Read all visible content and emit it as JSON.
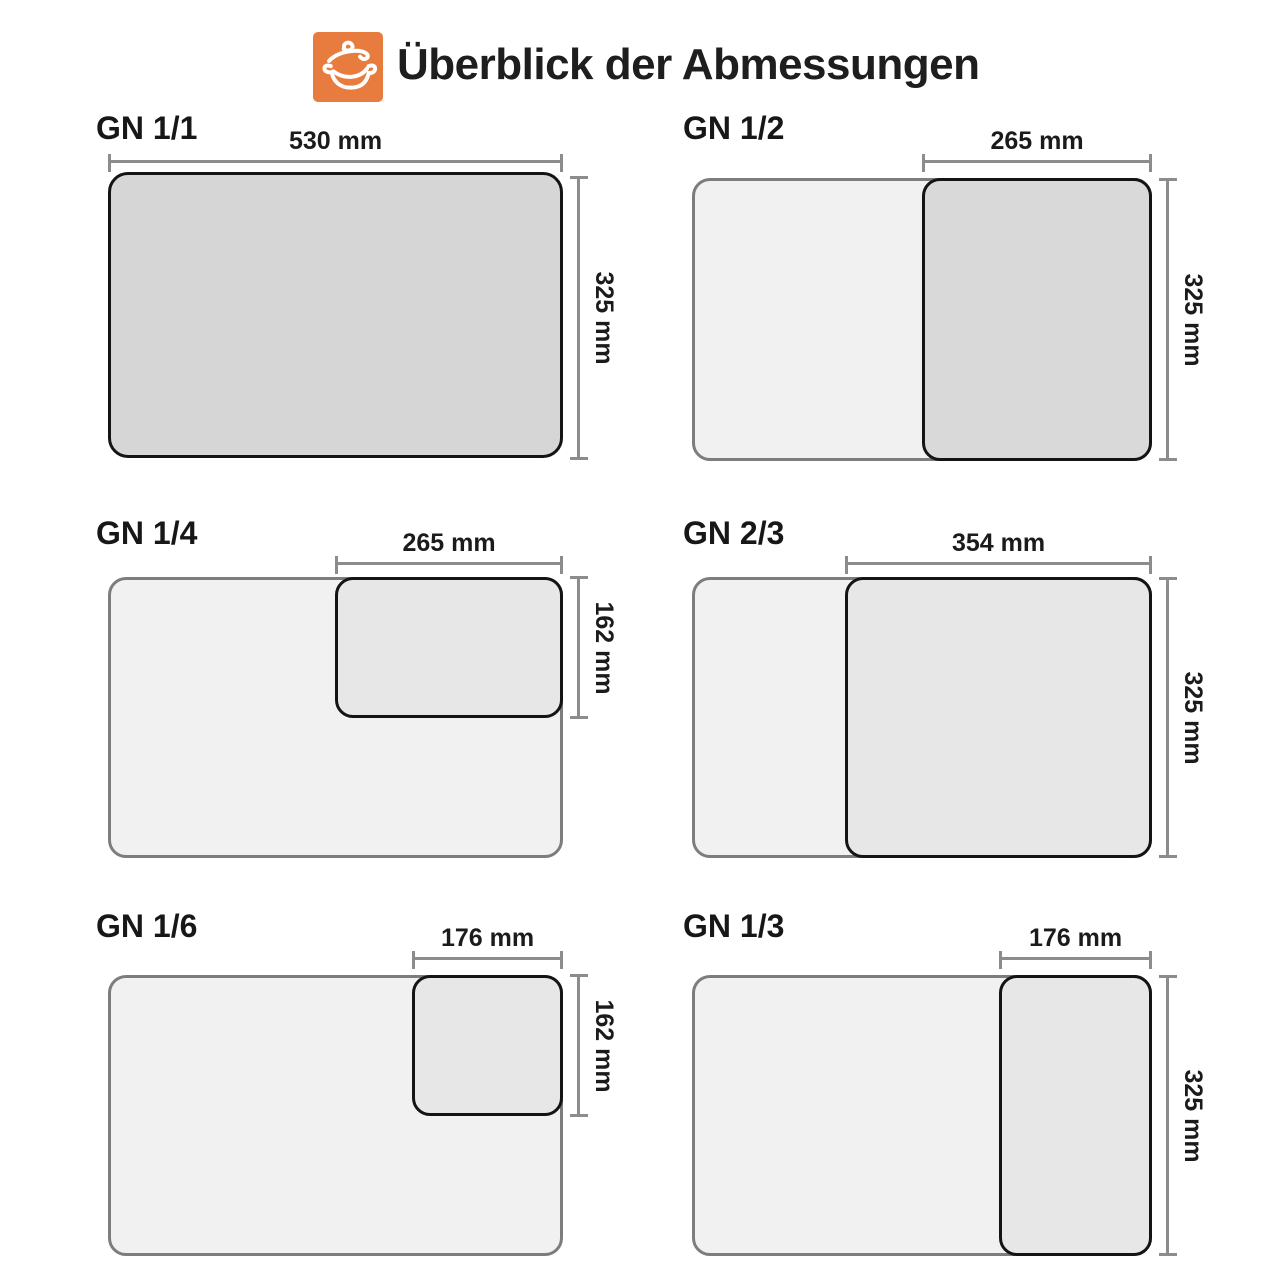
{
  "header": {
    "title": "Überblick der Abmessungen",
    "logo_icon": "pot-icon",
    "logo_color": "#e87c3e"
  },
  "colors": {
    "accent_orange": "#e87c3e",
    "full_pan_fill": "#d6d6d6",
    "half_pan_fill": "#d9d9d9",
    "small_pan_fill": "#e7e7e7",
    "base_pan_fill": "#f1f1f1",
    "base_pan_outline": "#7d7d7d",
    "highlight_outline": "#141414",
    "dimension_line": "#8c8c8c"
  },
  "panels": [
    {
      "label": "GN 1/1",
      "width_label": "530 mm",
      "height_label": "325 mm",
      "width_mm": 530,
      "height_mm": 325
    },
    {
      "label": "GN 1/2",
      "width_label": "265 mm",
      "height_label": "325 mm",
      "width_mm": 265,
      "height_mm": 325
    },
    {
      "label": "GN 1/4",
      "width_label": "265 mm",
      "height_label": "162 mm",
      "width_mm": 265,
      "height_mm": 162
    },
    {
      "label": "GN 2/3",
      "width_label": "354 mm",
      "height_label": "325 mm",
      "width_mm": 354,
      "height_mm": 325
    },
    {
      "label": "GN 1/6",
      "width_label": "176 mm",
      "height_label": "162 mm",
      "width_mm": 176,
      "height_mm": 162
    },
    {
      "label": "GN 1/3",
      "width_label": "176 mm",
      "height_label": "325 mm",
      "width_mm": 176,
      "height_mm": 325
    }
  ]
}
